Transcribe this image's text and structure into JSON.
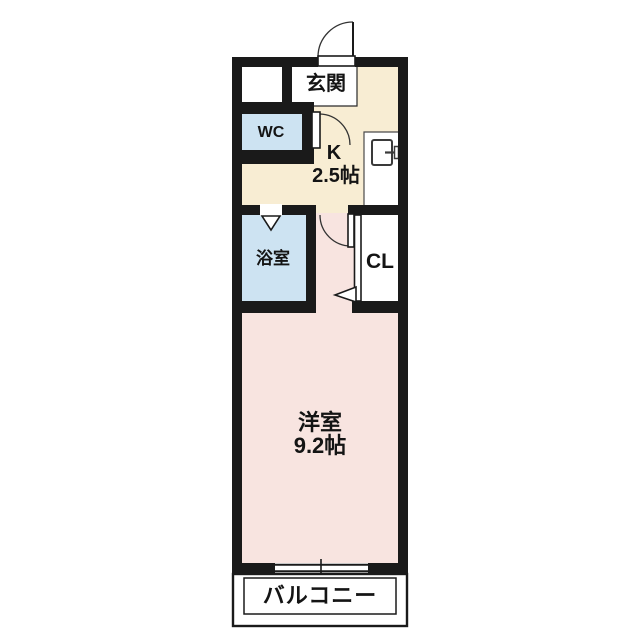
{
  "plan": {
    "rooms": {
      "genkan": {
        "label": "玄関"
      },
      "wc": {
        "label": "WC"
      },
      "kitchen": {
        "label": "K",
        "size": "2.5帖"
      },
      "bathroom": {
        "label": "浴室"
      },
      "closet": {
        "label": "CL"
      },
      "western_room": {
        "label": "洋室",
        "size": "9.2帖"
      },
      "balcony": {
        "label": "バルコニー"
      }
    },
    "colors": {
      "wall": "#1a1a1a",
      "kitchen_floor": "#f8edd3",
      "room_floor": "#f8e4e0",
      "wet_area_floor": "#cde3f2",
      "white": "#ffffff"
    }
  }
}
